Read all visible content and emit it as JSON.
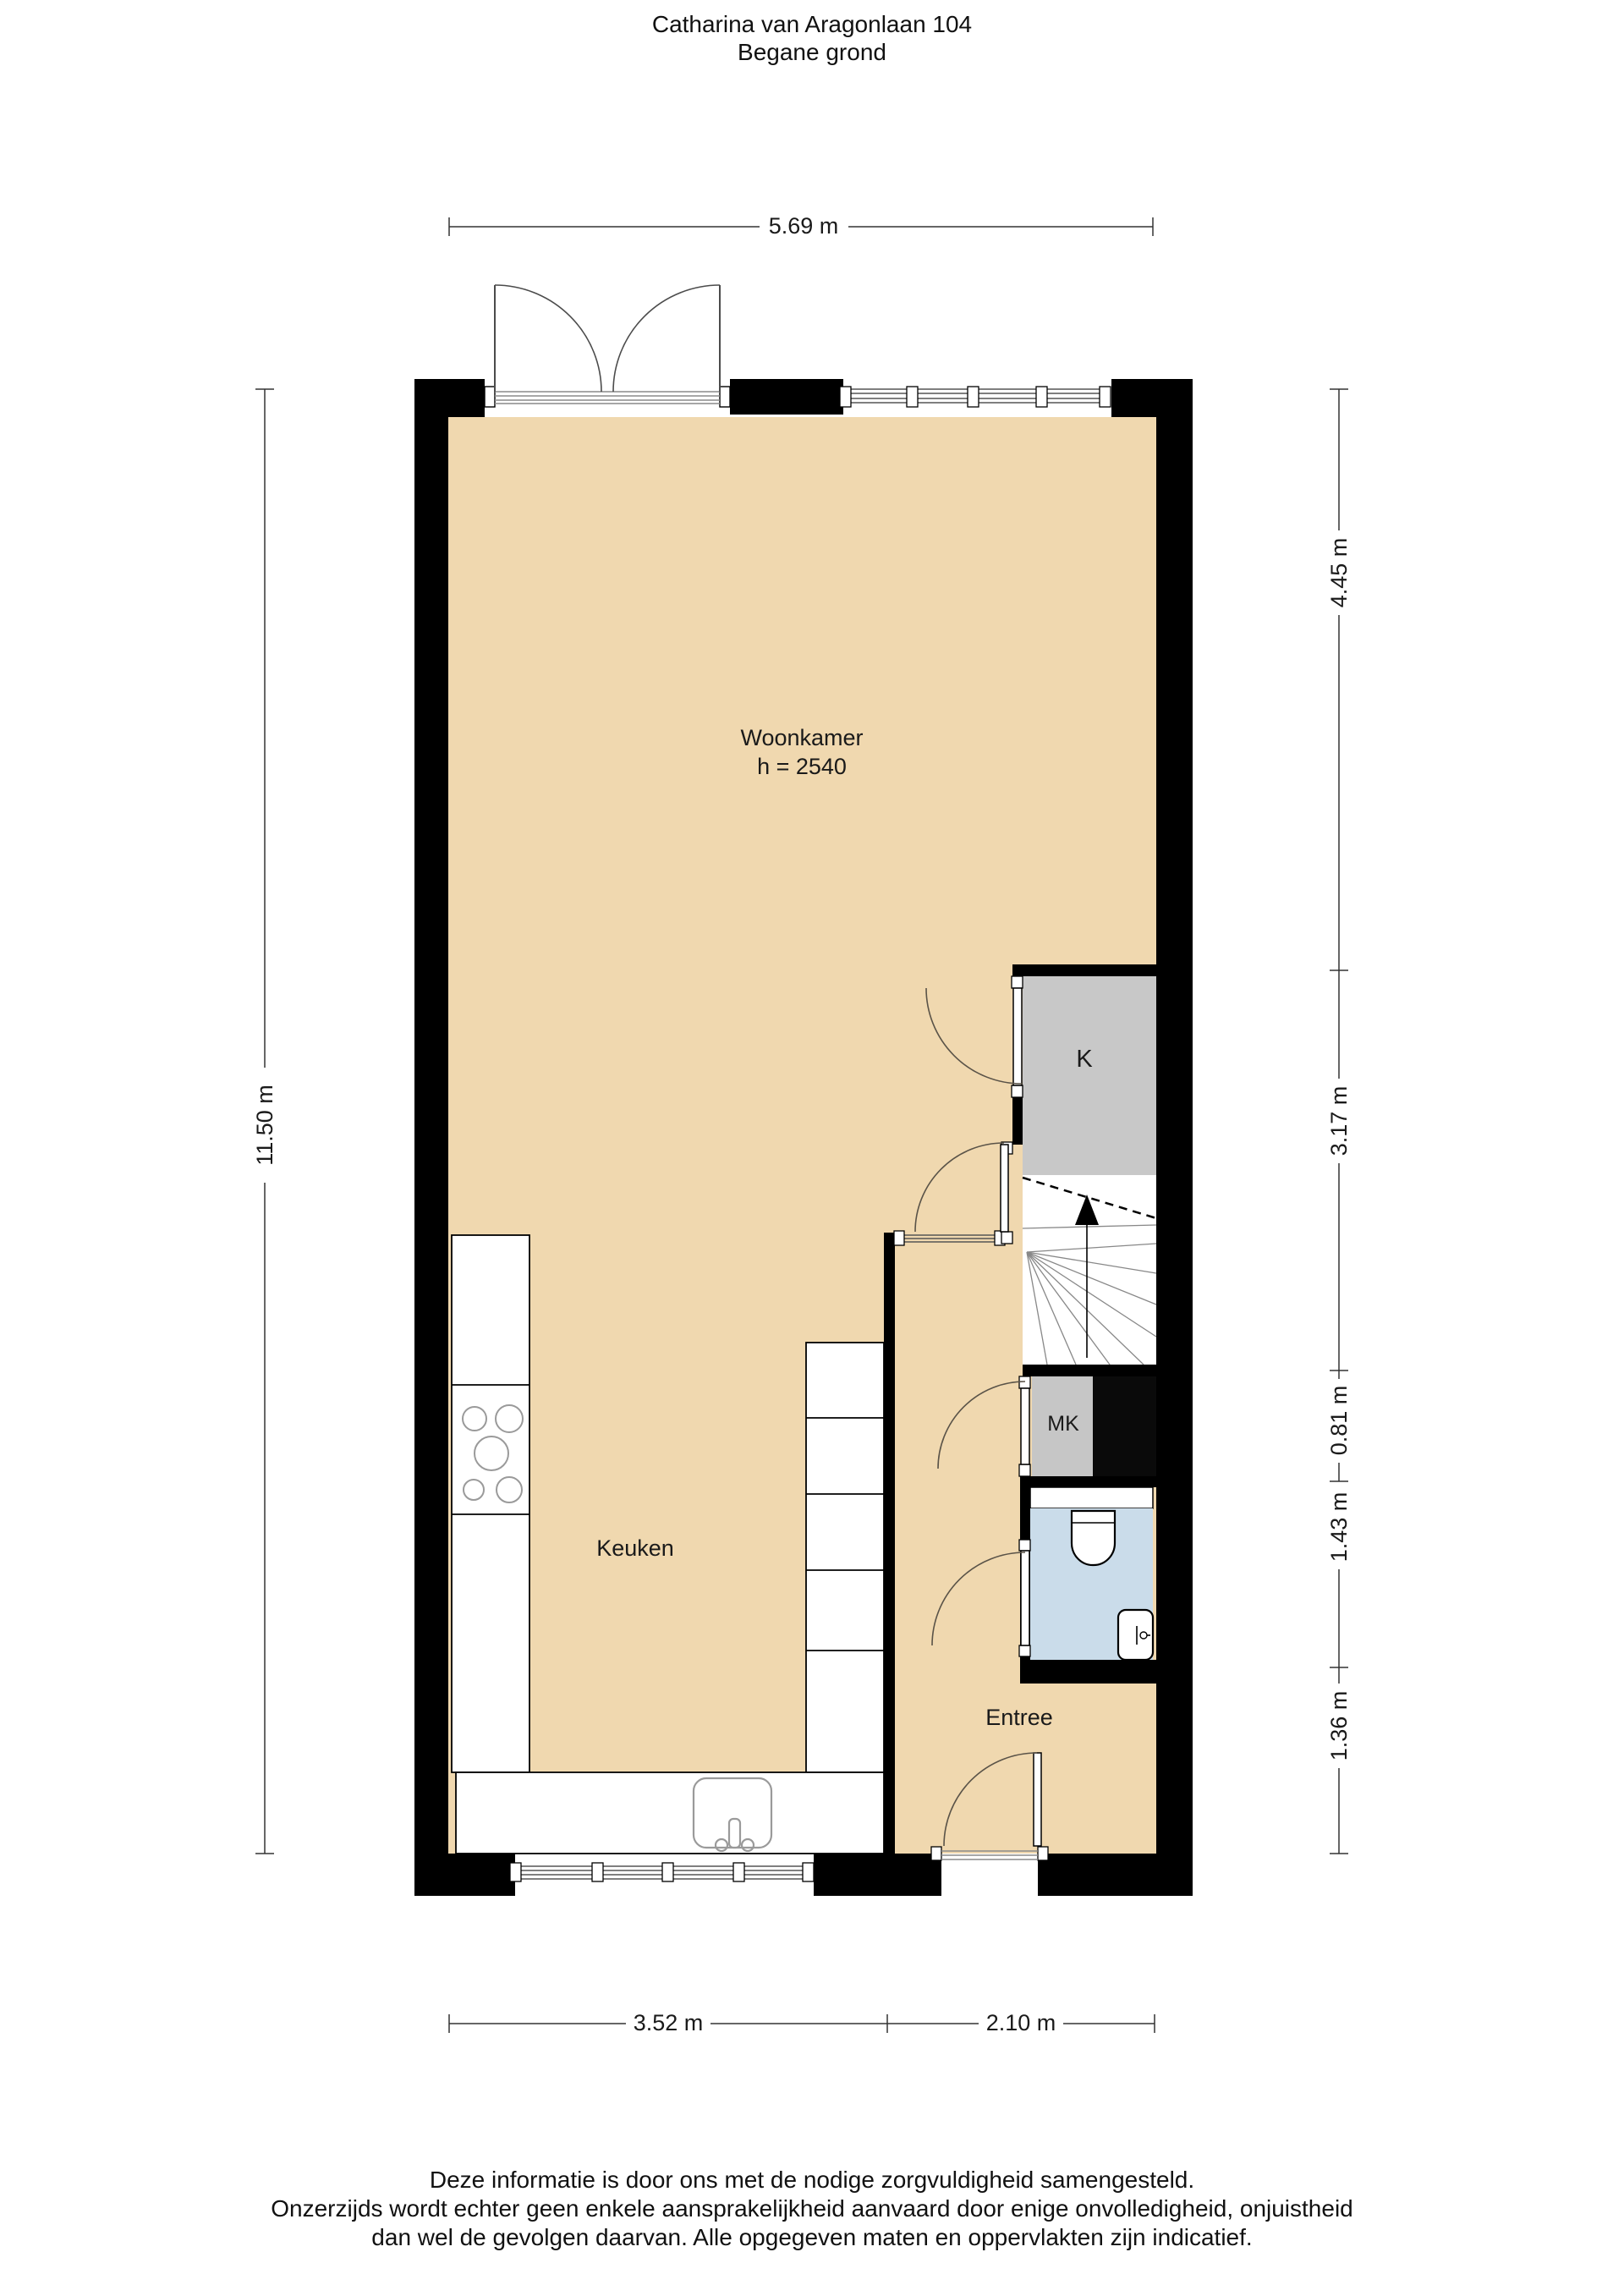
{
  "title": {
    "line1": "Catharina van Aragonlaan 104",
    "line2": "Begane grond"
  },
  "plan": {
    "rooms": {
      "woonkamer": {
        "label": "Woonkamer",
        "ceiling_height": "h = 2540"
      },
      "keuken": {
        "label": "Keuken"
      },
      "entree": {
        "label": "Entree"
      },
      "kast": {
        "label": "K"
      },
      "meterkast": {
        "label": "MK"
      }
    },
    "dimensions": {
      "top_width": "5.69 m",
      "left_height": "11.50 m",
      "right": [
        "4.45 m",
        "3.17 m",
        "0.81 m",
        "1.43 m",
        "1.36 m"
      ],
      "bottom": [
        "3.52 m",
        "2.10 m"
      ]
    }
  },
  "colors": {
    "floor": "#f0d8af",
    "wall": "#000000",
    "closet": "#c8c8c8",
    "toilet_floor": "#cadcea",
    "background": "#ffffff"
  },
  "footer": {
    "line1": "Deze informatie is door ons met de nodige zorgvuldigheid samengesteld.",
    "line2": "Onzerzijds wordt echter geen enkele aansprakelijkheid aanvaard door enige onvolledigheid, onjuistheid",
    "line3": "dan wel de gevolgen daarvan. Alle opgegeven maten en oppervlakten zijn indicatief."
  }
}
